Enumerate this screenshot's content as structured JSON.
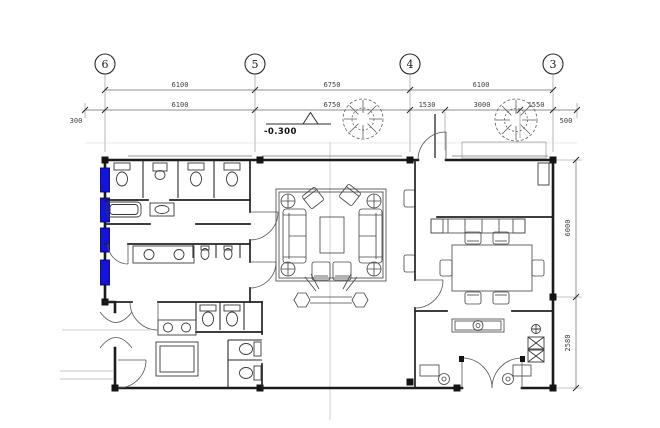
{
  "meta": {
    "drawing_type": "architectural floor plan, ground floor with restrooms, lounge, dining and entrance vestibule"
  },
  "grid": {
    "labels": [
      "6",
      "5",
      "4",
      "3"
    ]
  },
  "dimensions": {
    "row1": [
      "6100",
      "6750",
      "6100"
    ],
    "row2": [
      "6100",
      "6750",
      "1530",
      "3000",
      "1550"
    ],
    "edge_left": "300",
    "edge_right": "500",
    "side_right": [
      "6000",
      "2580"
    ]
  },
  "elevation": {
    "label": "-0.300"
  },
  "colors": {
    "wall": "#1c1c1c",
    "dimension_text": "#3f3f3f",
    "centerline": "#bdbdbd",
    "window_highlight_blue": "#1414d8"
  }
}
